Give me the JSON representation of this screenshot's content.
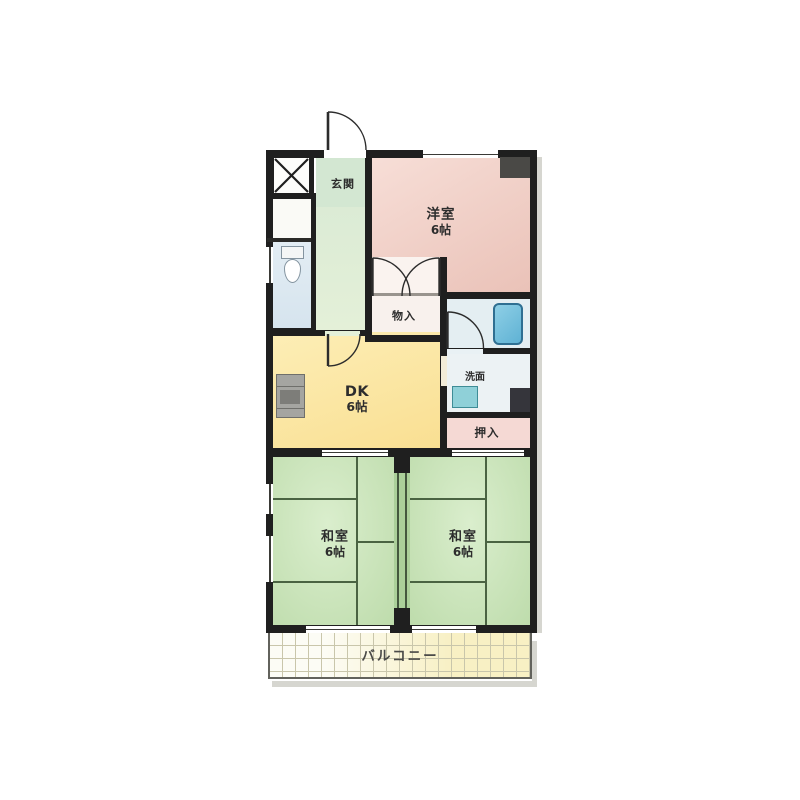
{
  "plan": {
    "type": "apartment-floor-plan",
    "rooms": {
      "genkan": {
        "label": "玄関"
      },
      "youshitsu": {
        "name": "洋室",
        "size": "6帖"
      },
      "monoire": {
        "label": "物入"
      },
      "dk": {
        "name": "DK",
        "size": "6帖"
      },
      "senmen": {
        "label": "洗面"
      },
      "oshiire": {
        "label": "押入"
      },
      "washitsu_left": {
        "name": "和室",
        "size": "6帖"
      },
      "washitsu_right": {
        "name": "和室",
        "size": "6帖"
      },
      "balcony": {
        "label": "バルコニー"
      }
    },
    "colors": {
      "wall": "#1f1f1f",
      "youshitsu_pink": "#efc9c0",
      "washitsu_green": "#c8e3b8",
      "tatami_line": "#4a6342",
      "dk_yellow": "#fbe49a",
      "corridor_mint": "#e0efda",
      "toilet_blue": "#dde9f1",
      "bath_blue": "#e4eef2",
      "bathtub": "#74c0dc",
      "sink_teal": "#8fd0d8",
      "closet_white": "#f8f1ed",
      "oshiire_pink": "#f5d9d4",
      "balcony_cream": "#f8f0c4",
      "counter_gray": "#a5a5a1",
      "dark_shaft": "#35353b",
      "corner_column": "#4a4946"
    }
  }
}
